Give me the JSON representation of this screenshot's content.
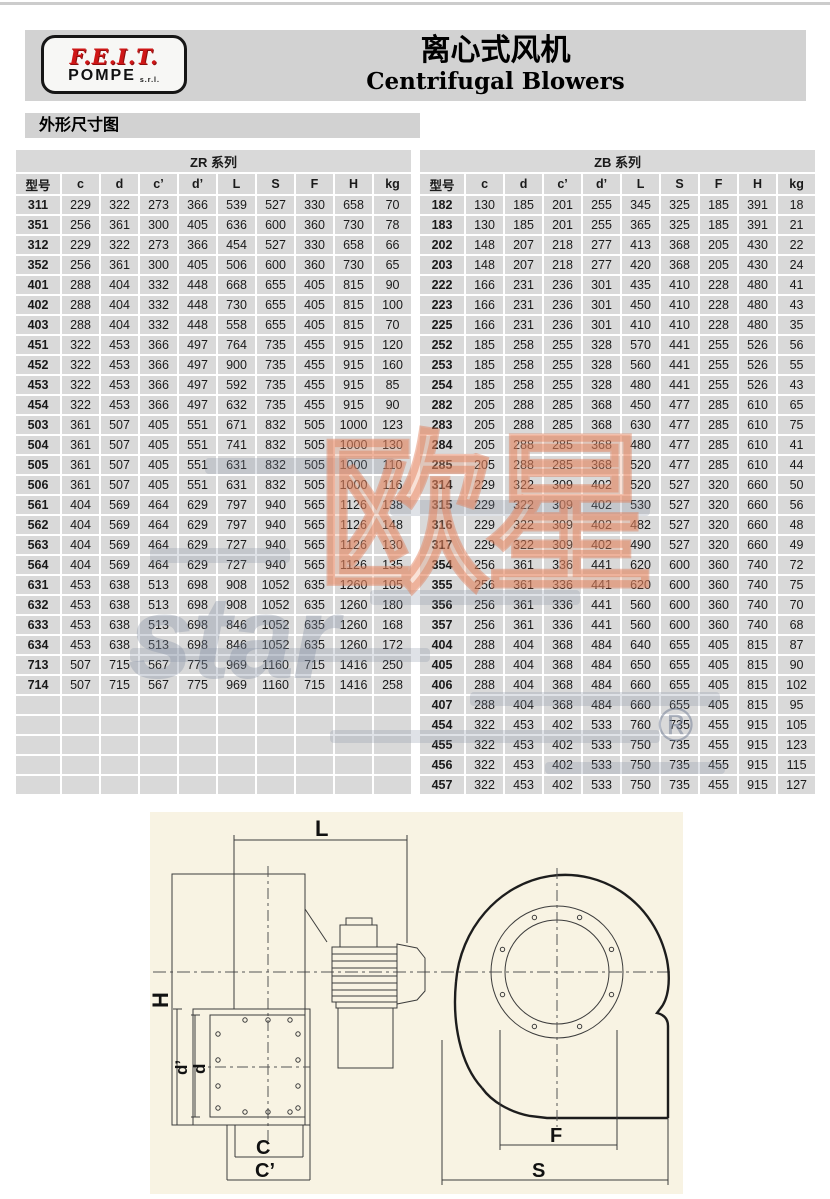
{
  "page": {
    "title_cn": "离心式风机",
    "title_en": "Centrifugal Blowers",
    "section_title": "外形尺寸图"
  },
  "logo": {
    "brand": "F.E.I.T.",
    "sub": "POMPE",
    "suffix": "s.r.l."
  },
  "table": {
    "headers": [
      "型号",
      "c",
      "d",
      "c’",
      "d’",
      "L",
      "S",
      "F",
      "H",
      "kg"
    ],
    "total_rows": 30,
    "zr": {
      "title": "ZR 系列",
      "rows": [
        [
          "311",
          229,
          322,
          273,
          366,
          539,
          527,
          330,
          658,
          70
        ],
        [
          "351",
          256,
          361,
          300,
          405,
          636,
          600,
          360,
          730,
          78
        ],
        [
          "312",
          229,
          322,
          273,
          366,
          454,
          527,
          330,
          658,
          66
        ],
        [
          "352",
          256,
          361,
          300,
          405,
          506,
          600,
          360,
          730,
          65
        ],
        [
          "401",
          288,
          404,
          332,
          448,
          668,
          655,
          405,
          815,
          90
        ],
        [
          "402",
          288,
          404,
          332,
          448,
          730,
          655,
          405,
          815,
          100
        ],
        [
          "403",
          288,
          404,
          332,
          448,
          558,
          655,
          405,
          815,
          70
        ],
        [
          "451",
          322,
          453,
          366,
          497,
          764,
          735,
          455,
          915,
          120
        ],
        [
          "452",
          322,
          453,
          366,
          497,
          900,
          735,
          455,
          915,
          160
        ],
        [
          "453",
          322,
          453,
          366,
          497,
          592,
          735,
          455,
          915,
          85
        ],
        [
          "454",
          322,
          453,
          366,
          497,
          632,
          735,
          455,
          915,
          90
        ],
        [
          "503",
          361,
          507,
          405,
          551,
          671,
          832,
          505,
          1000,
          123
        ],
        [
          "504",
          361,
          507,
          405,
          551,
          741,
          832,
          505,
          1000,
          130
        ],
        [
          "505",
          361,
          507,
          405,
          551,
          631,
          832,
          505,
          1000,
          110
        ],
        [
          "506",
          361,
          507,
          405,
          551,
          631,
          832,
          505,
          1000,
          116
        ],
        [
          "561",
          404,
          569,
          464,
          629,
          797,
          940,
          565,
          1126,
          138
        ],
        [
          "562",
          404,
          569,
          464,
          629,
          797,
          940,
          565,
          1126,
          148
        ],
        [
          "563",
          404,
          569,
          464,
          629,
          727,
          940,
          565,
          1126,
          130
        ],
        [
          "564",
          404,
          569,
          464,
          629,
          727,
          940,
          565,
          1126,
          135
        ],
        [
          "631",
          453,
          638,
          513,
          698,
          908,
          1052,
          635,
          1260,
          105
        ],
        [
          "632",
          453,
          638,
          513,
          698,
          908,
          1052,
          635,
          1260,
          180
        ],
        [
          "633",
          453,
          638,
          513,
          698,
          846,
          1052,
          635,
          1260,
          168
        ],
        [
          "634",
          453,
          638,
          513,
          698,
          846,
          1052,
          635,
          1260,
          172
        ],
        [
          "713",
          507,
          715,
          567,
          775,
          969,
          1160,
          715,
          1416,
          250
        ],
        [
          "714",
          507,
          715,
          567,
          775,
          969,
          1160,
          715,
          1416,
          258
        ]
      ]
    },
    "zb": {
      "title": "ZB 系列",
      "rows": [
        [
          "182",
          130,
          185,
          201,
          255,
          345,
          325,
          185,
          391,
          18
        ],
        [
          "183",
          130,
          185,
          201,
          255,
          365,
          325,
          185,
          391,
          21
        ],
        [
          "202",
          148,
          207,
          218,
          277,
          413,
          368,
          205,
          430,
          22
        ],
        [
          "203",
          148,
          207,
          218,
          277,
          420,
          368,
          205,
          430,
          24
        ],
        [
          "222",
          166,
          231,
          236,
          301,
          435,
          410,
          228,
          480,
          41
        ],
        [
          "223",
          166,
          231,
          236,
          301,
          450,
          410,
          228,
          480,
          43
        ],
        [
          "225",
          166,
          231,
          236,
          301,
          410,
          410,
          228,
          480,
          35
        ],
        [
          "252",
          185,
          258,
          255,
          328,
          570,
          441,
          255,
          526,
          56
        ],
        [
          "253",
          185,
          258,
          255,
          328,
          560,
          441,
          255,
          526,
          55
        ],
        [
          "254",
          185,
          258,
          255,
          328,
          480,
          441,
          255,
          526,
          43
        ],
        [
          "282",
          205,
          288,
          285,
          368,
          450,
          477,
          285,
          610,
          65
        ],
        [
          "283",
          205,
          288,
          285,
          368,
          630,
          477,
          285,
          610,
          75
        ],
        [
          "284",
          205,
          288,
          285,
          368,
          480,
          477,
          285,
          610,
          41
        ],
        [
          "285",
          205,
          288,
          285,
          368,
          520,
          477,
          285,
          610,
          44
        ],
        [
          "314",
          229,
          322,
          309,
          402,
          520,
          527,
          320,
          660,
          50
        ],
        [
          "315",
          229,
          322,
          309,
          402,
          530,
          527,
          320,
          660,
          56
        ],
        [
          "316",
          229,
          322,
          309,
          402,
          482,
          527,
          320,
          660,
          48
        ],
        [
          "317",
          229,
          322,
          309,
          402,
          490,
          527,
          320,
          660,
          49
        ],
        [
          "354",
          256,
          361,
          336,
          441,
          620,
          600,
          360,
          740,
          72
        ],
        [
          "355",
          256,
          361,
          336,
          441,
          620,
          600,
          360,
          740,
          75
        ],
        [
          "356",
          256,
          361,
          336,
          441,
          560,
          600,
          360,
          740,
          70
        ],
        [
          "357",
          256,
          361,
          336,
          441,
          560,
          600,
          360,
          740,
          68
        ],
        [
          "404",
          288,
          404,
          368,
          484,
          640,
          655,
          405,
          815,
          87
        ],
        [
          "405",
          288,
          404,
          368,
          484,
          650,
          655,
          405,
          815,
          90
        ],
        [
          "406",
          288,
          404,
          368,
          484,
          660,
          655,
          405,
          815,
          102
        ],
        [
          "407",
          288,
          404,
          368,
          484,
          660,
          655,
          405,
          815,
          95
        ],
        [
          "454",
          322,
          453,
          402,
          533,
          760,
          735,
          455,
          915,
          105
        ],
        [
          "455",
          322,
          453,
          402,
          533,
          750,
          735,
          455,
          915,
          123
        ],
        [
          "456",
          322,
          453,
          402,
          533,
          750,
          735,
          455,
          915,
          115
        ],
        [
          "457",
          322,
          453,
          402,
          533,
          750,
          735,
          455,
          915,
          127
        ]
      ]
    }
  },
  "watermark": {
    "cjk": "欧星",
    "latin": "star",
    "registered": "®"
  },
  "drawing": {
    "labels": {
      "L": "L",
      "H": "H",
      "d_prime": "d’",
      "d": "d",
      "C": "C",
      "C_prime": "C’",
      "F": "F",
      "S": "S"
    }
  }
}
